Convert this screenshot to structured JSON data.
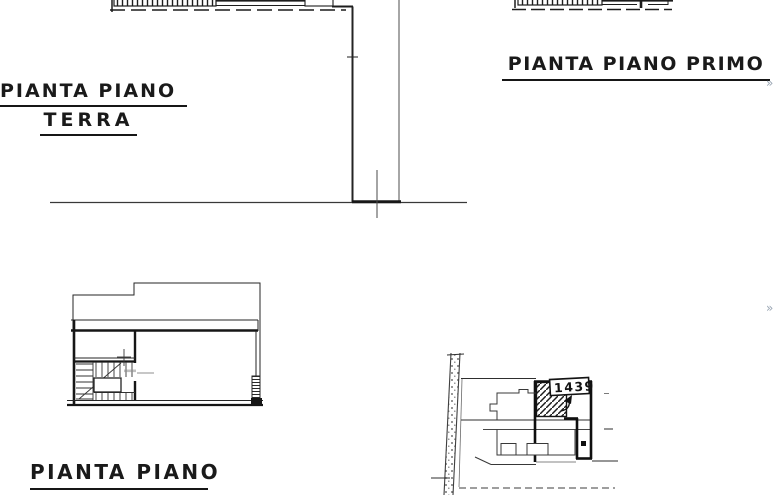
{
  "colors": {
    "ink": "#1a1a1a",
    "paper": "#ffffff",
    "scan_marker": "#9aa6b4"
  },
  "labels": {
    "ground_floor": {
      "line1": "PIANTA PIANO",
      "line2": "TERRA"
    },
    "first_floor": "PIANTA PIANO PRIMO",
    "lower_plan": "PIANTA PIANO"
  },
  "site_plan": {
    "parcel_number": "1439"
  },
  "markers": {
    "top_right": "»",
    "middle_right": "»"
  }
}
